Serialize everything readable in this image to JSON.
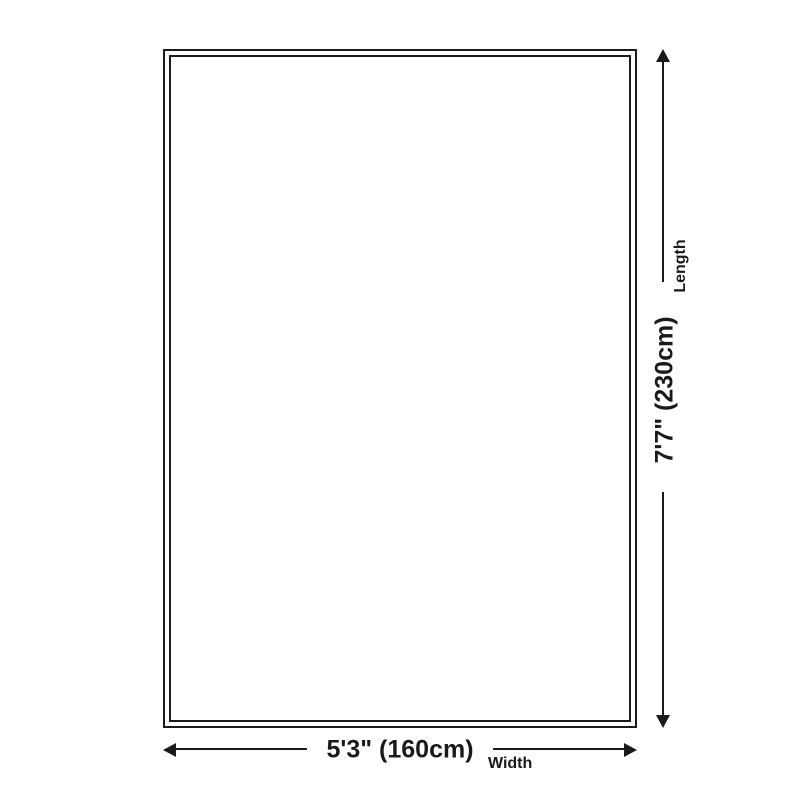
{
  "diagram": {
    "type": "product-size-diagram",
    "shape": "rectangle",
    "colors": {
      "line": "#1a1a1a",
      "background": "#ffffff"
    },
    "length": {
      "value": "7'7\" (230cm)",
      "label": "Length"
    },
    "width": {
      "value": "5'3\" (160cm)",
      "label": "Width"
    }
  }
}
